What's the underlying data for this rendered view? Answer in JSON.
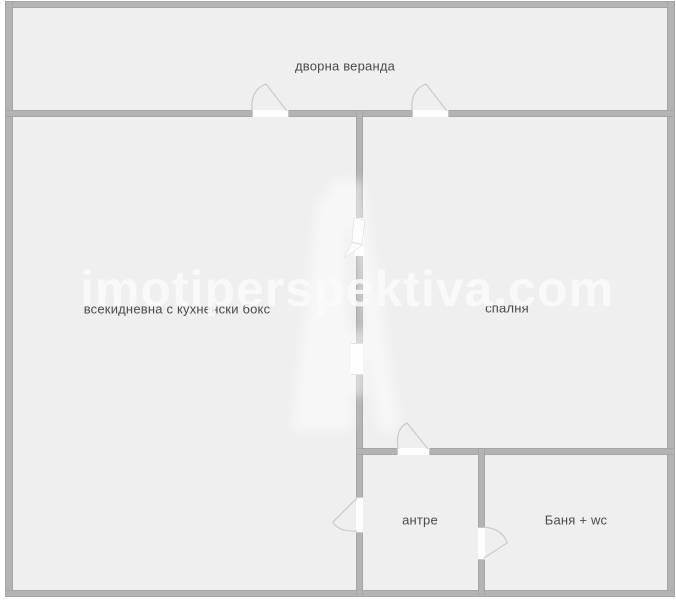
{
  "plan": {
    "watermark_text": "imotiperspektiva.com",
    "rooms": [
      {
        "name": "veranda",
        "label": "дворна веранда"
      },
      {
        "name": "living-room",
        "label": "всекидневна с кухненски бокс"
      },
      {
        "name": "bedroom",
        "label": "спалня"
      },
      {
        "name": "hallway",
        "label": "антре"
      },
      {
        "name": "bathroom",
        "label": "Баня + wc"
      }
    ],
    "colors": {
      "wall": "#b3b3b3",
      "room_fill": "#efefef",
      "door_slab": "#fdfdfd",
      "door_arc": "#cccccc",
      "label_text": "#4a4a4a",
      "watermark": "#fbfbfb",
      "outside": "#ffffff"
    }
  }
}
